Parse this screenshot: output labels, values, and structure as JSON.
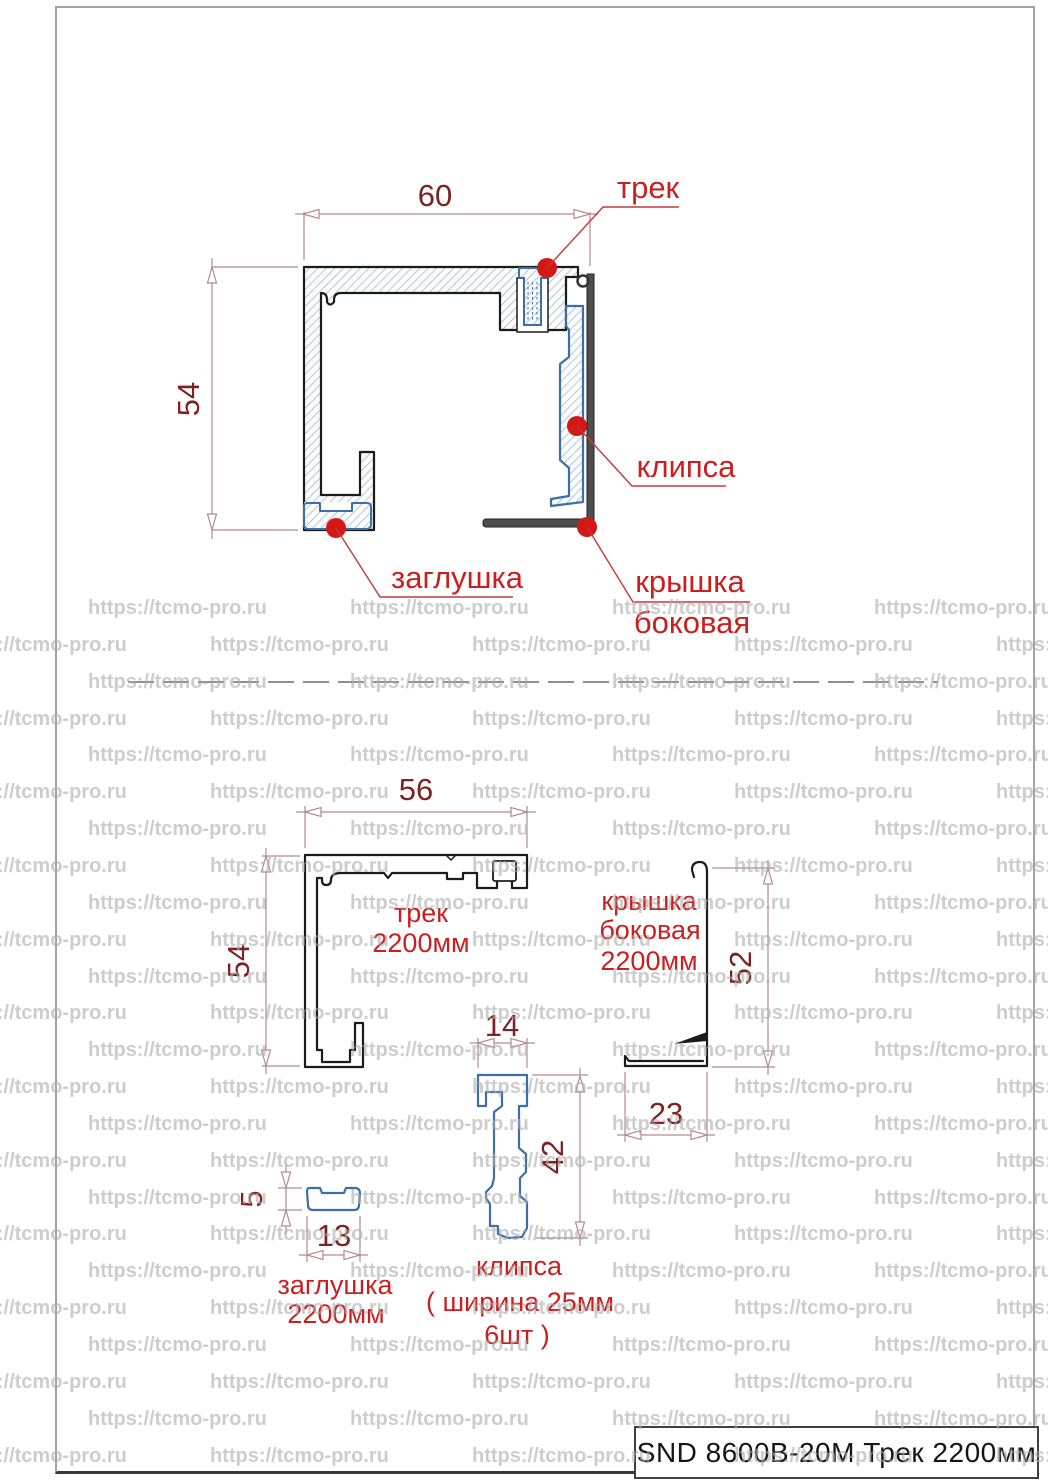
{
  "watermark": {
    "text": "https://tcmo-pro.ru"
  },
  "title_block": {
    "text": "SND 8600B-20M Трек 2200мм"
  },
  "assembly": {
    "dim_width": "60",
    "dim_height": "54",
    "label_track": "трек",
    "label_clip": "клипса",
    "label_plug": "заглушка",
    "label_cover_1": "крышка",
    "label_cover_2": "боковая"
  },
  "track_part": {
    "dim_width": "56",
    "dim_height": "54",
    "label_1": "трек",
    "label_2": "2200мм"
  },
  "cover_part": {
    "dim_height": "52",
    "dim_width": "23",
    "label_1": "крышка",
    "label_2": "боковая",
    "label_3": "2200мм"
  },
  "clip_part": {
    "dim_width": "14",
    "dim_height": "42",
    "label_1": "клипса",
    "label_2": "( ширина 25мм",
    "label_3": "6шт )"
  },
  "plug_part": {
    "dim_height": "5",
    "dim_width": "13",
    "label_1": "заглушка",
    "label_2": "2200мм"
  },
  "colors": {
    "label_red": "#cb1f1f",
    "dot_red": "#d31818",
    "dim_text": "#7d2121",
    "dim_line": "#b58a8a",
    "profile_black": "#1b1b1b",
    "part_blue": "#3c6fa8",
    "cover_dark": "#4e4e4e",
    "watermark_gray": "#acacac",
    "frame_gray": "#a2a2a2"
  }
}
